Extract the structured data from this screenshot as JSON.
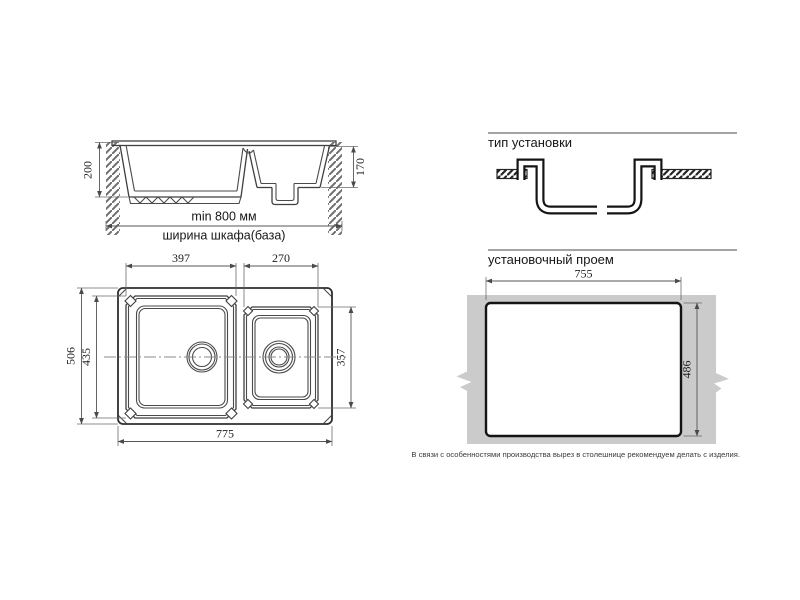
{
  "drawing": {
    "cross_section": {
      "depth_left": "200",
      "depth_right": "170",
      "cabinet_min_width": "min 800 мм",
      "cabinet_caption": "ширина шкафа(база)"
    },
    "installation_type": {
      "title": "тип установки"
    },
    "plan": {
      "bowl1_width": "397",
      "bowl2_width": "270",
      "overall_depth": "506",
      "bowl1_depth": "435",
      "bowl2_depth": "357",
      "overall_width": "775"
    },
    "cutout": {
      "title": "установочный проем",
      "width": "755",
      "depth": "486",
      "note": "В связи с особенностями производства вырез в столешнице рекомендуем делать с изделия."
    },
    "colors": {
      "line": "#3f3f3f",
      "thick_line": "#141414",
      "countertop_gray": "#cbcbcb",
      "dim_line": "#555555",
      "text": "#1f1f1f"
    }
  }
}
